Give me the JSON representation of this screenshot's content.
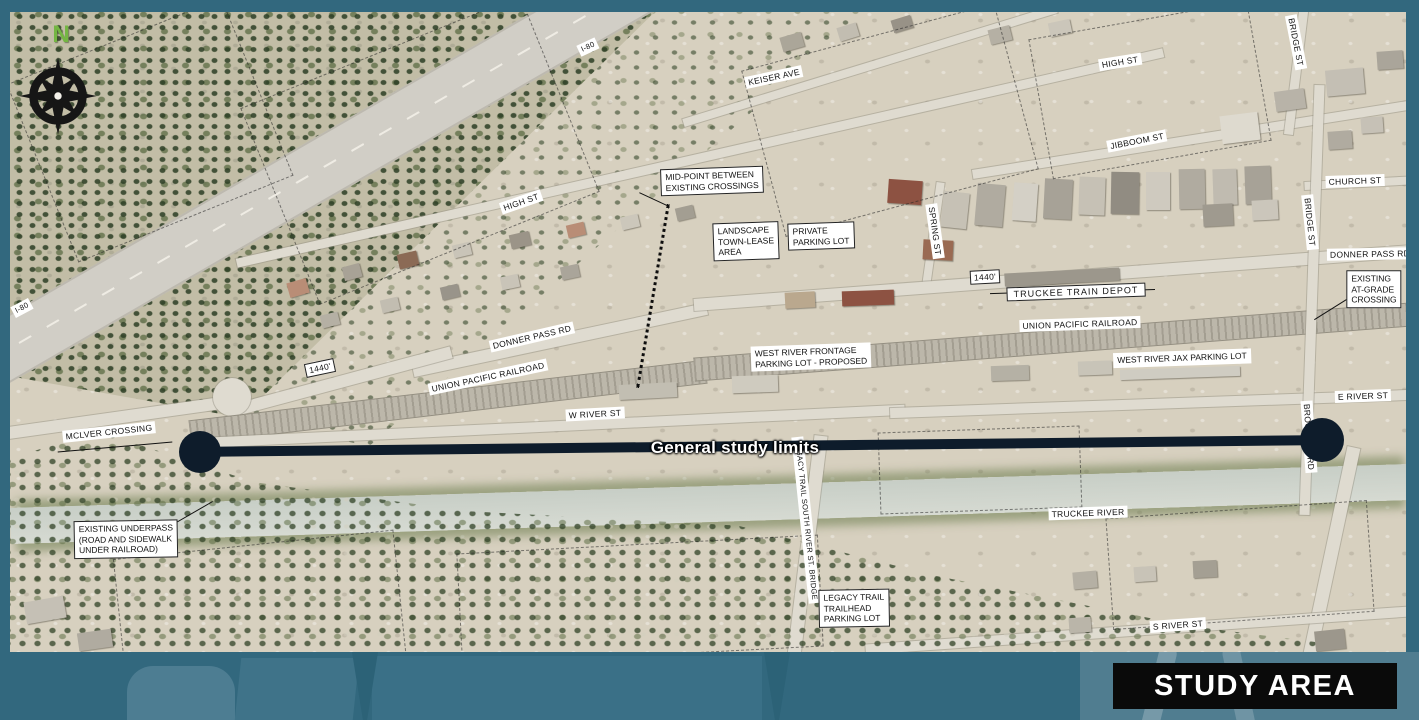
{
  "colors": {
    "frame_teal": "#32687e",
    "footer_light": "#4d7d92",
    "study_line": "#0e1c2b",
    "badge_bg": "#0a0a0a",
    "badge_text": "#ffffff",
    "north_green": "#74b643"
  },
  "compass": {
    "north": "N"
  },
  "badge": {
    "label": "STUDY AREA"
  },
  "study_line": {
    "label": "General study limits"
  },
  "streets": {
    "i80_top": "I-80",
    "i80_left": "I-80",
    "keiser": "KEISER AVE",
    "high_left": "HIGH ST",
    "high_right": "HIGH ST",
    "bridge_top": "BRIDGE ST",
    "bridge_right": "BRIDGE ST",
    "jibboom": "JIBBOOM ST",
    "church": "CHURCH ST",
    "donner_left": "DONNER PASS RD",
    "donner_right": "DONNER PASS RD",
    "spring": "SPRING ST",
    "uprr_left": "UNION PACIFIC RAILROAD",
    "uprr_right": "UNION PACIFIC RAILROAD",
    "w_river": "W RIVER ST",
    "e_river": "E RIVER ST",
    "s_river": "S RIVER ST",
    "truckee_river": "TRUCKEE RIVER",
    "mclver": "MCLVER CROSSING",
    "brockway": "BROCKWAY RD",
    "legacy_bridge": "LEGACY TRAIL SOUTH RIVER ST. BRIDGE",
    "depot": "TRUCKEE TRAIN DEPOT",
    "dist_left": "1440'",
    "dist_right": "1440'"
  },
  "callouts": {
    "midpoint": {
      "lines": [
        "MID-POINT BETWEEN",
        "EXISTING CROSSINGS"
      ]
    },
    "landscape": {
      "lines": [
        "LANDSCAPE",
        "TOWN-LEASE",
        "AREA"
      ]
    },
    "private_lot": {
      "lines": [
        "PRIVATE",
        "PARKING LOT"
      ]
    },
    "at_grade": {
      "lines": [
        "EXISTING",
        "AT-GRADE",
        "CROSSING"
      ]
    },
    "underpass": {
      "lines": [
        "EXISTING UNDERPASS",
        "(ROAD AND SIDEWALK",
        "UNDER RAILROAD)"
      ]
    },
    "legacy_lot": {
      "lines": [
        "LEGACY TRAIL",
        "TRAILHEAD",
        "PARKING LOT"
      ]
    },
    "frontage": {
      "lines": [
        "WEST RIVER FRONTAGE",
        "PARKING LOT - PROPOSED"
      ]
    },
    "jax": {
      "lines": [
        "WEST RIVER JAX PARKING LOT"
      ]
    }
  }
}
